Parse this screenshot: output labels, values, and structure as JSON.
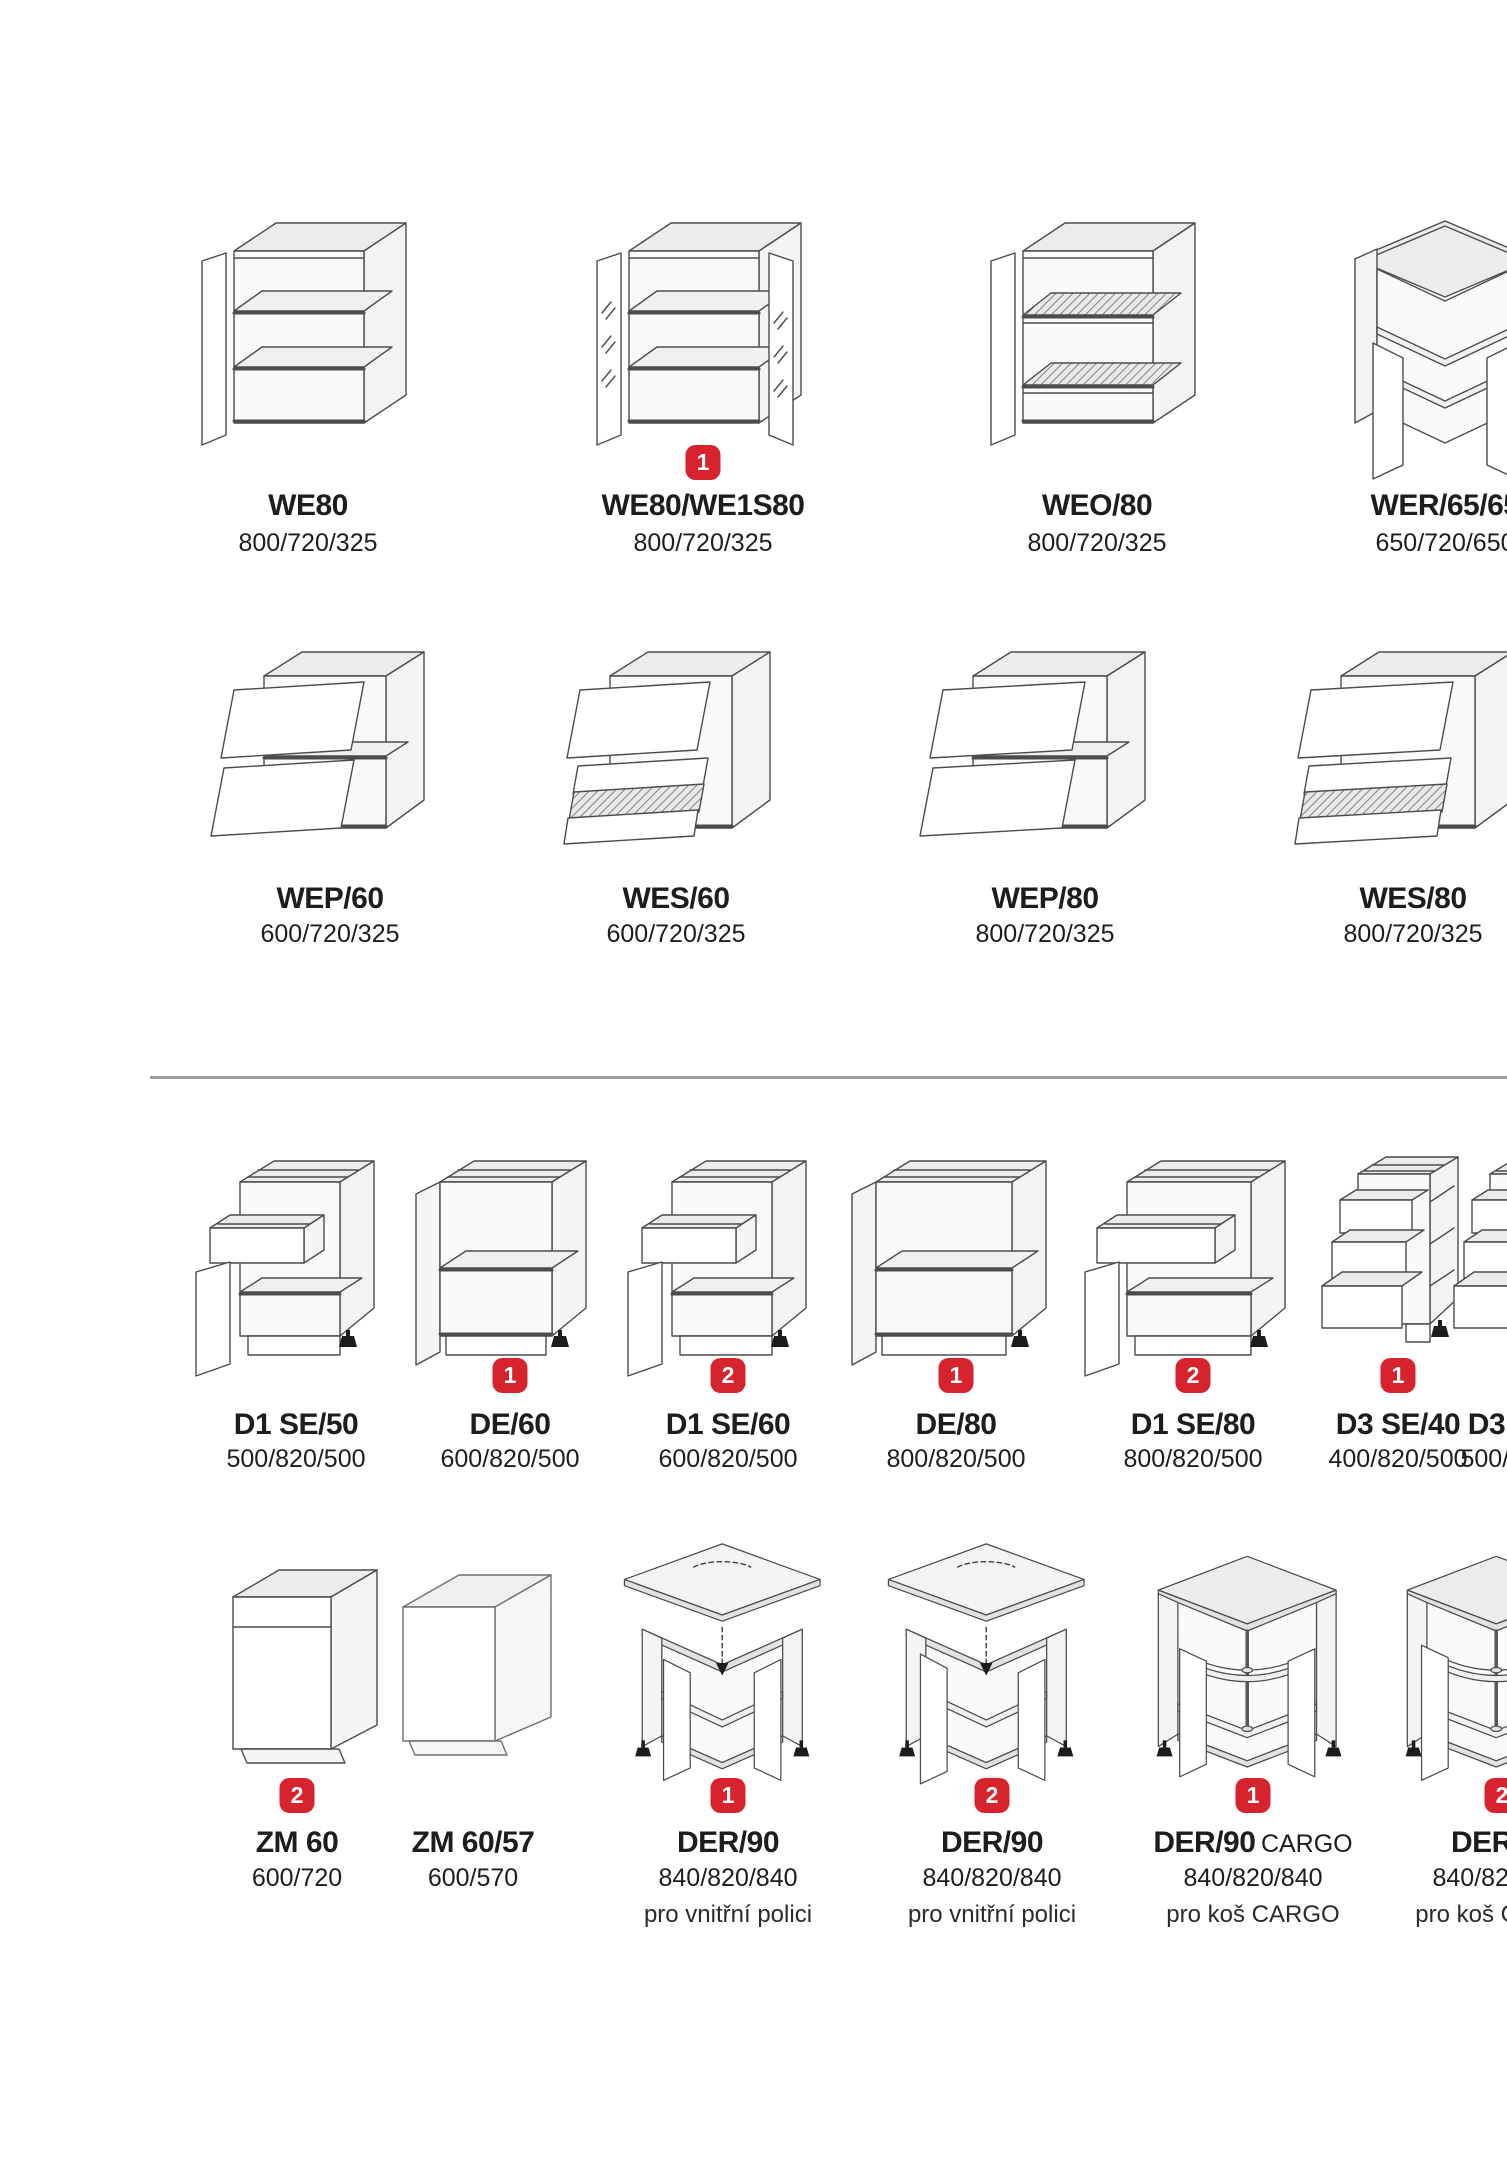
{
  "page": {
    "background": "#ffffff"
  },
  "style": {
    "badge_bg": "#d7232e",
    "badge_text": "#ffffff",
    "divider_color": "#9b9b9b",
    "text_color": "#1d1d1b"
  },
  "rows": [
    {
      "section": "wall-cabinets-shelves",
      "items": [
        {
          "model": "WE80",
          "dims": "800/720/325"
        },
        {
          "model": "WE80/WE1S80",
          "dims": "800/720/325",
          "badge": "1"
        },
        {
          "model": "WEO/80",
          "dims": "800/720/325"
        },
        {
          "model": "WER/65/65",
          "dims": "650/720/650"
        }
      ]
    },
    {
      "section": "wall-cabinets-liftup",
      "items": [
        {
          "model": "WEP/60",
          "dims": "600/720/325"
        },
        {
          "model": "WES/60",
          "dims": "600/720/325"
        },
        {
          "model": "WEP/80",
          "dims": "800/720/325"
        },
        {
          "model": "WES/80",
          "dims": "800/720/325"
        }
      ]
    },
    {
      "section": "base-cabinets",
      "items": [
        {
          "model": "D1 SE/50",
          "dims": "500/820/500"
        },
        {
          "model": "DE/60",
          "dims": "600/820/500",
          "badge": "1"
        },
        {
          "model": "D1 SE/60",
          "dims": "600/820/500",
          "badge": "2"
        },
        {
          "model": "DE/80",
          "dims": "800/820/500",
          "badge": "1"
        },
        {
          "model": "D1 SE/80",
          "dims": "800/820/500",
          "badge": "2"
        },
        {
          "model": "D3 SE/40",
          "dims": "400/820/500",
          "badge": "1"
        },
        {
          "model": "D3 SE/50",
          "dims": "500/820/500"
        }
      ]
    },
    {
      "section": "special-and-corner-base",
      "items": [
        {
          "model": "ZM 60",
          "dims": "600/720",
          "badge": "2"
        },
        {
          "model": "ZM 60/57",
          "dims": "600/570"
        },
        {
          "model": "DER/90",
          "dims": "840/820/840",
          "badge": "1",
          "note": "pro vnitřní polici"
        },
        {
          "model": "DER/90",
          "dims": "840/820/840",
          "badge": "2",
          "note": "pro vnitřní polici"
        },
        {
          "model": "DER/90",
          "suffix": "CARGO",
          "dims": "840/820/840",
          "badge": "1",
          "note": "pro koš CARGO"
        },
        {
          "model": "DER/90",
          "dims": "840/820/840",
          "badge": "2",
          "note": "pro koš CARGO"
        }
      ]
    }
  ]
}
